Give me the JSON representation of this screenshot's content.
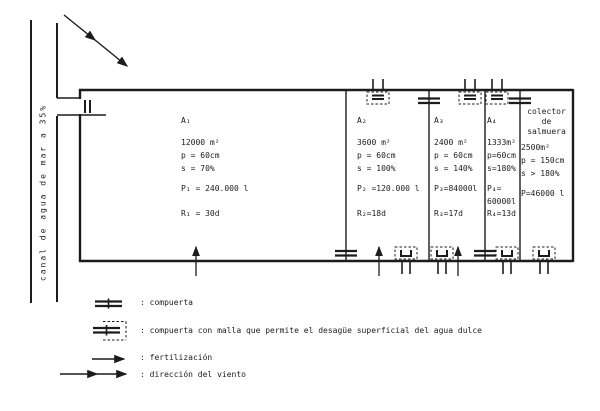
{
  "canal": {
    "label": "canal de agua de mar a 35%"
  },
  "compartments": [
    {
      "name": "A₁",
      "area": "12000 m²",
      "depth": "p = 60cm",
      "salinity": "s = 70%",
      "production": "P₁ = 240.000 l",
      "residence": "R₁ = 30d"
    },
    {
      "name": "A₂",
      "area": "3600 m²",
      "depth": "p = 60cm",
      "salinity": "s = 100%",
      "production": "P₂ =120.000 l",
      "residence": "R₂=18d"
    },
    {
      "name": "A₃",
      "area": "2400 m²",
      "depth": "p = 60cm",
      "salinity": "s = 140%",
      "production": "P₃=84000l",
      "residence": "R₃=17d"
    },
    {
      "name": "A₄",
      "area": "1333m²",
      "depth": "p=60cm",
      "salinity": "s=180%",
      "production": "P₄=\n60000l",
      "residence": "R₄=13d"
    }
  ],
  "collector": {
    "title": "colector\nde\nsalmuera",
    "area": "2500m²",
    "depth": "p = 150cm",
    "salinity": "s > 180%",
    "production": "P=46000 l"
  },
  "legend": [
    {
      "symbol": "compuerta-icon",
      "label": ": compuerta"
    },
    {
      "symbol": "compuerta-malla-icon",
      "label": ": compuerta con malla que permite el desagüe superficial del agua dulce"
    },
    {
      "symbol": "fertilizacion-arrow-icon",
      "label": ": fertilización"
    },
    {
      "symbol": "viento-arrow-icon",
      "label": ": dirección del viento"
    }
  ],
  "colors": {
    "ink": "#1c1c1c",
    "paper": "#ffffff"
  }
}
